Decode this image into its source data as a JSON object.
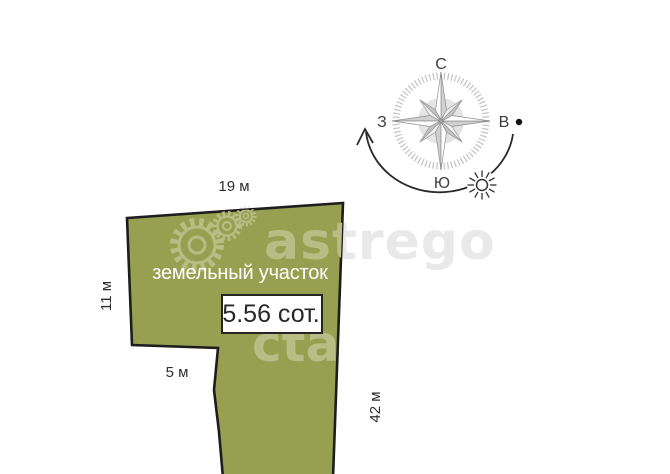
{
  "compass": {
    "labels": {
      "north": "С",
      "east": "В",
      "south": "Ю",
      "west": "З"
    }
  },
  "plot": {
    "title": "земельный участок",
    "area": "5.56 сот.",
    "dimensions": {
      "top": "19 м",
      "left": "11 м",
      "bottom": "5 м",
      "right": "42 м"
    }
  },
  "watermark": {
    "brand": "astrego",
    "fragment": "cta"
  },
  "colors": {
    "plot_fill": "#96a050",
    "plot_stroke": "#1d1d1d",
    "label_text": "#2e2e2e",
    "plot_title_text": "#ffffff",
    "area_text": "#272727",
    "watermark_on_white": "#e9e9e9",
    "watermark_on_plot": "#b7bd85"
  }
}
